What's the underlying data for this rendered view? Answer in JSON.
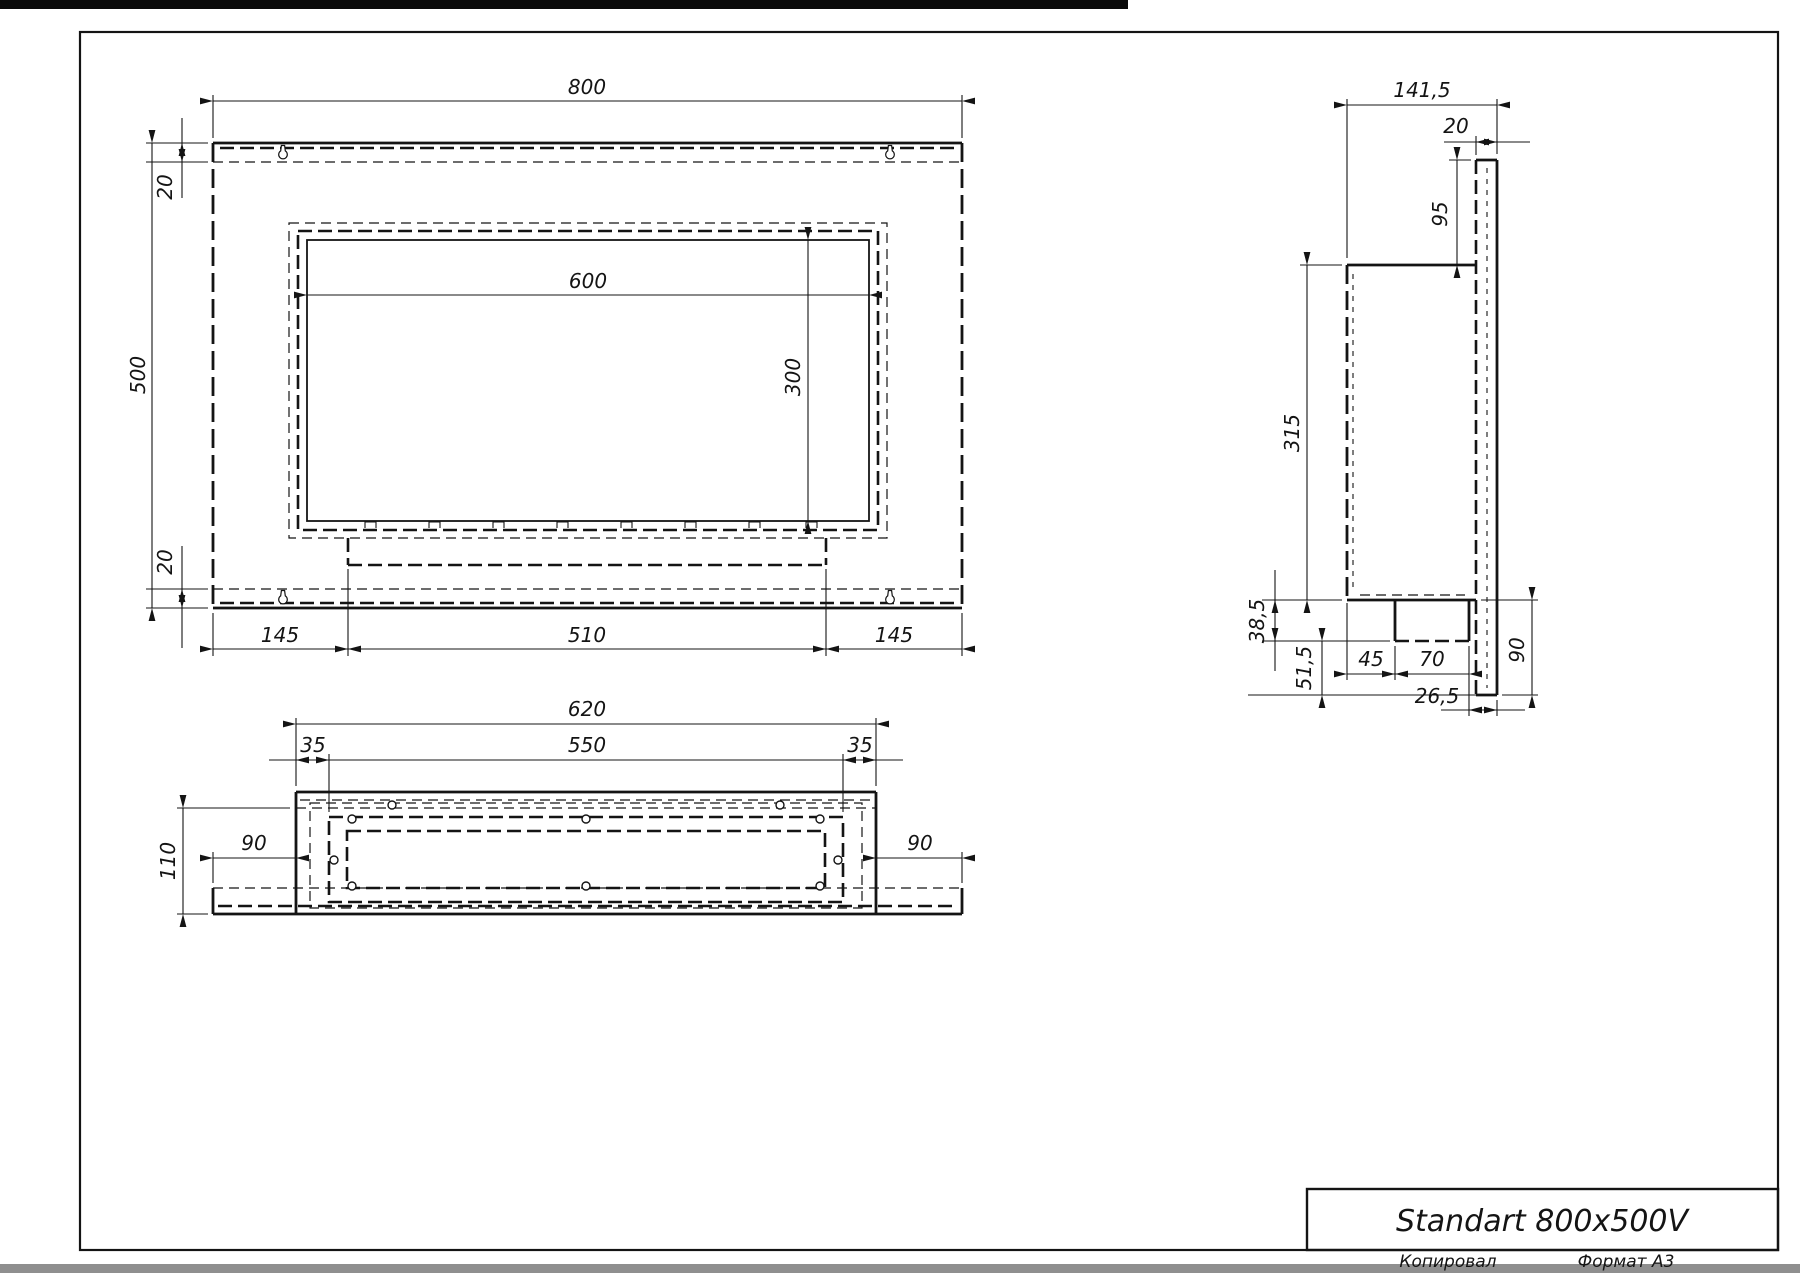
{
  "front_view": {
    "width": "800",
    "height": "500",
    "flange_top": "20",
    "flange_bottom": "20",
    "opening_width": "600",
    "opening_height": "300",
    "margin_left": "145",
    "burner_width": "510",
    "margin_right": "145"
  },
  "side_view": {
    "depth": "141,5",
    "plate_thickness": "20",
    "top_offset": "95",
    "body_height": "315",
    "tray_depth": "38,5",
    "bottom_offset": "51,5",
    "tray_front_gap": "45",
    "tray_length": "70",
    "lower_height": "90",
    "back_gap": "26,5"
  },
  "bottom_view": {
    "body_width": "620",
    "opening_width": "550",
    "inset_left": "35",
    "inset_right": "35",
    "depth": "110",
    "side_left": "90",
    "side_right": "90"
  },
  "title_block": {
    "title": "Standart 800x500V",
    "copier_label": "Копировал",
    "format_label": "Формат А3"
  }
}
